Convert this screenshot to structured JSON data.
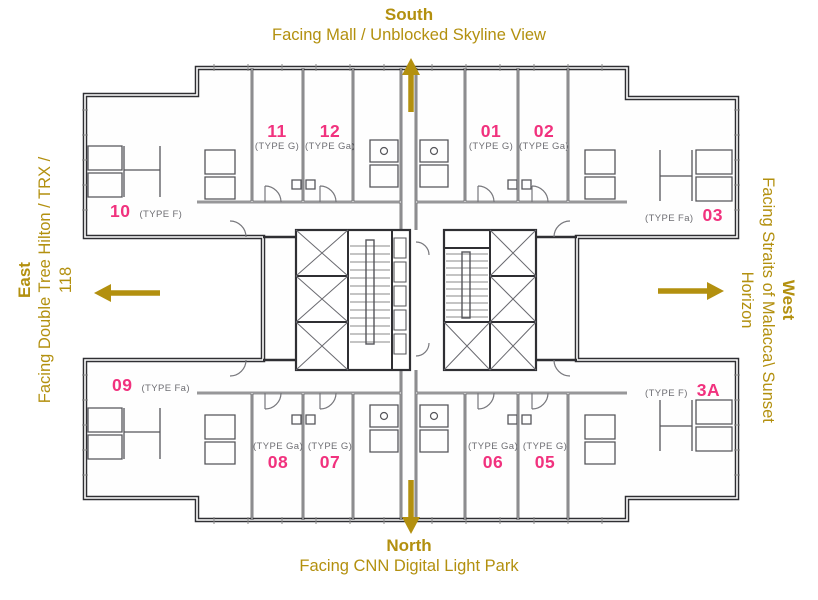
{
  "compass": {
    "south": {
      "name": "South",
      "facing": "Facing Mall / Unblocked Skyline View"
    },
    "north": {
      "name": "North",
      "facing": "Facing CNN Digital Light Park"
    },
    "east": {
      "name": "East",
      "facing_line1": "Facing Double Tree Hilton / TRX /",
      "facing_line2": "118"
    },
    "west": {
      "name": "West",
      "facing_line1": "Facing Straits of Malacca\\ Sunset",
      "facing_line2": "Horizon"
    }
  },
  "units": {
    "u11": {
      "number": "11",
      "type": "(TYPE G)"
    },
    "u12": {
      "number": "12",
      "type": "(TYPE Ga)"
    },
    "u01": {
      "number": "01",
      "type": "(TYPE G)"
    },
    "u02": {
      "number": "02",
      "type": "(TYPE Ga)"
    },
    "u10": {
      "number": "10",
      "type": "(TYPE F)"
    },
    "u03": {
      "number": "03",
      "type": "(TYPE Fa)"
    },
    "u09": {
      "number": "09",
      "type": "(TYPE Fa)"
    },
    "u3A": {
      "number": "3A",
      "type": "(TYPE F)"
    },
    "u08": {
      "number": "08",
      "type": "(TYPE Ga)"
    },
    "u07": {
      "number": "07",
      "type": "(TYPE G)"
    },
    "u06": {
      "number": "06",
      "type": "(TYPE Ga)"
    },
    "u05": {
      "number": "05",
      "type": "(TYPE G)"
    }
  },
  "colors": {
    "accent_gold": "#B3900F",
    "unit_number_pink": "#F1327E",
    "wall_dark": "#2F2F33",
    "detail_gray": "#6E6E73"
  }
}
